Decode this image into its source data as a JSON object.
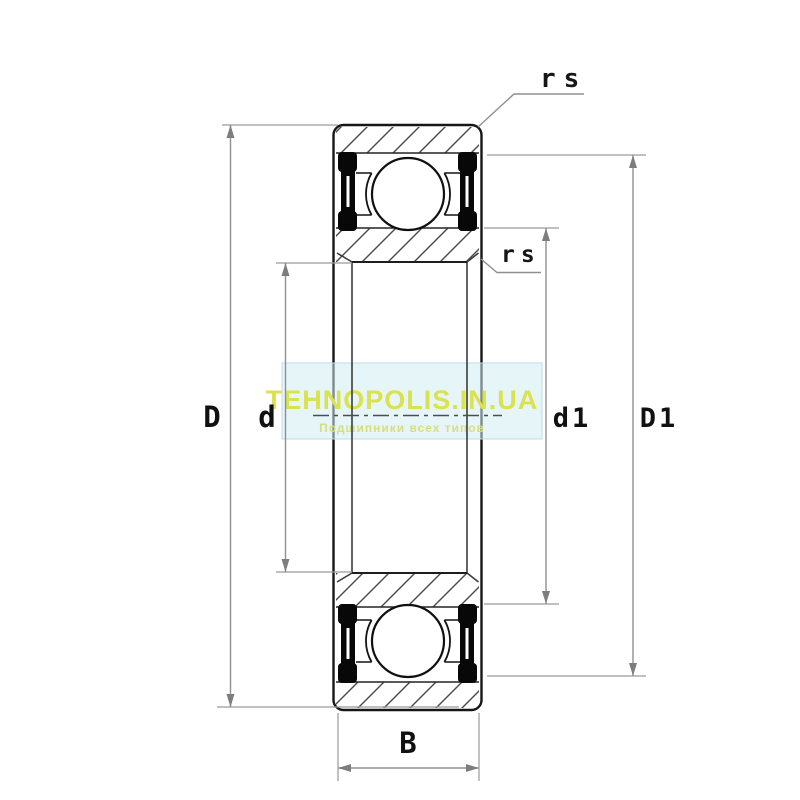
{
  "dimensions": {
    "outer_diameter_label": "D",
    "bore_label": "d",
    "inner_shoulder_label": "d1",
    "outer_shoulder_label": "D1",
    "width_label": "B",
    "chamfer_top_label": "rs",
    "chamfer_side_label": "rs"
  },
  "watermark": {
    "text": "TEHNOPOLIS.IN.UA",
    "subtext": "Подшипники всех типов",
    "text_color": "#dbe24f",
    "subtext_color": "#d6df7d",
    "panel_fill": "rgba(210,236,243,0.55)",
    "panel_border": "#bcdce4"
  },
  "colors": {
    "background": "#ffffff",
    "drawing_line": "#161616",
    "dimension_line": "#8f8f8f",
    "hatch_line": "#4a4a4a",
    "seal": "#080808"
  }
}
